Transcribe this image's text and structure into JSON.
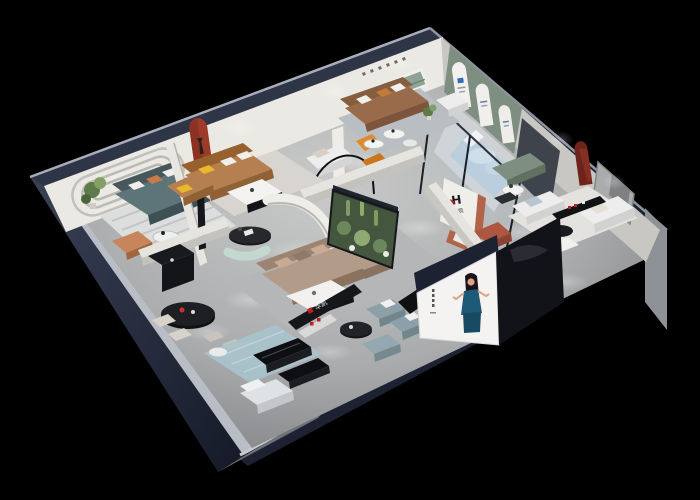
{
  "brand": {
    "showroom_logo_letter": "H",
    "showroom_logo_name": "华凯",
    "front_sign_text": "华凯"
  },
  "palette": {
    "navy": "#2e3547",
    "navydark": "#1d2232",
    "walltop": "#b9bdc6",
    "facade": "#8e9195",
    "exterior": "#6f7276",
    "floora": "#c7c8c8",
    "floorb": "#8f9092",
    "wallwhite": "#ebe9e3",
    "wallshade": "#c9c7c2",
    "sage": "#7e8f81",
    "nichegreen": "#8ea295",
    "archred": "#9e3a28",
    "darkred": "#6e241b",
    "terracotta": "#b2644a",
    "caramel": "#b67f50",
    "cognac": "#96602f",
    "slate": "#5d7478",
    "slatedark": "#46585c",
    "taupe": "#b39b89",
    "taupedark": "#9c8472",
    "mint": "#c3d8cf",
    "plantdark": "#2f4429",
    "plant": "#5d7a4a",
    "plantlight": "#82a061",
    "glass": "#cfe0e8",
    "rugblue": "#a9c3cc",
    "ruggray": "#d6d5d3",
    "blackf": "#141518",
    "whitef": "#ecedec",
    "orange": "#e08a2a",
    "bluegray": "#8ba0a8",
    "bedblue": "#b7cbdc",
    "dress": "#1e5a78",
    "skin": "#d9a583",
    "hair": "#191419",
    "signred": "#c01f24",
    "cream": "#d8d3c9",
    "brown": "#9a6b4a",
    "browndark": "#875d40"
  }
}
